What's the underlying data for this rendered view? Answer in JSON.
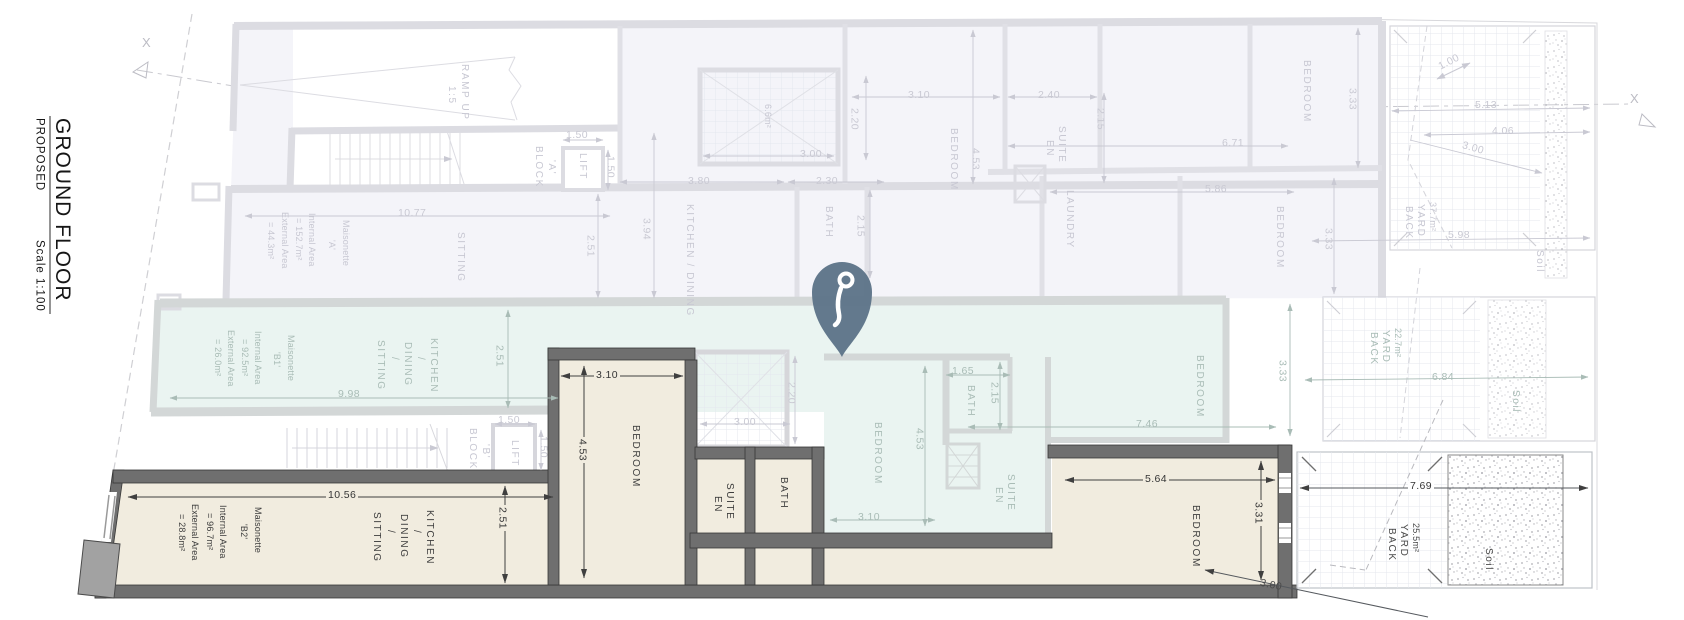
{
  "title_block": {
    "floor": "GROUND FLOOR",
    "status": "PROPOSED",
    "scale": "Scale 1:100"
  },
  "section_markers": {
    "left": "X",
    "right": "X"
  },
  "maisonette_a": {
    "name": "Maisonette",
    "unit_id": "'A'",
    "internal_label": "Internal Area",
    "internal_value": "= 152.7m²",
    "external_label": "External Area",
    "external_value": "= 44.3m²"
  },
  "maisonette_b1": {
    "name": "Maisonette",
    "unit_id": "'B1'",
    "internal_label": "Internal Area",
    "internal_value": "= 92.5m²",
    "external_label": "External Area",
    "external_value": "= 26.0m²"
  },
  "maisonette_b2": {
    "name": "Maisonette",
    "unit_id": "'B2'",
    "internal_label": "Internal Area",
    "internal_value": "= 96.7m²",
    "external_label": "External Area",
    "external_value": "= 28.8m²"
  },
  "labels_a": {
    "ramp_1": "RAMP UP",
    "ramp_2": "1:5",
    "block_1": "BLOCK",
    "block_2": "'A'",
    "lift": "LIFT",
    "sitting": "SITTING",
    "kitchen_dining": "KITCHEN / DINING",
    "bath": "BATH",
    "bedroom_1": "BEDROOM",
    "en_suite_1": "EN",
    "en_suite_2": "SUITE",
    "laundry": "LAUNDRY",
    "bedroom_2": "BEDROOM",
    "bedroom_3": "BEDROOM",
    "shaft_area": "6.6m²",
    "back_1": "BACK",
    "back_2": "YARD",
    "back_area": "37.7m²",
    "soil": "Soil"
  },
  "labels_b1": {
    "kds_1": "SITTING",
    "kds_2": "/",
    "kds_3": "DINING",
    "kds_4": "/",
    "kds_5": "KITCHEN",
    "bedroom_1": "BEDROOM",
    "bath": "BATH",
    "en_suite_1": "EN",
    "en_suite_2": "SUITE",
    "bedroom_2": "BEDROOM",
    "back_1": "BACK",
    "back_2": "YARD",
    "back_area": "22.7m²",
    "soil": "Soil"
  },
  "labels_blockb": {
    "block_1": "BLOCK",
    "block_2": "'B'",
    "lift": "LIFT"
  },
  "labels_b2": {
    "kds_1": "SITTING",
    "kds_2": "/",
    "kds_3": "DINING",
    "kds_4": "/",
    "kds_5": "KITCHEN",
    "bedroom_1": "BEDROOM",
    "en_suite_1": "EN",
    "en_suite_2": "SUITE",
    "bath": "BATH",
    "bedroom_2": "BEDROOM",
    "back_1": "BACK",
    "back_2": "YARD",
    "back_area": "25.5m²",
    "soil": "Soil"
  },
  "dims_a": {
    "lift_w": "1.50",
    "lift_d": "1.50",
    "sitting_w": "10.77",
    "sitting_d": "2.51",
    "kitchen_d": "3.94",
    "kitchen_w": "3.80",
    "bath_w": "2.30",
    "shaft_w": "3.00",
    "shaft_d": "2.20",
    "bath_d": "2.15",
    "bedroom1_w": "3.10",
    "bedroom1_d": "4.53",
    "ensuite_w": "2.40",
    "ensuite_d": "2.15",
    "bedroom2_w": "6.71",
    "bedroom2_d": "3.33",
    "bedroom3_w": "5.86",
    "bedroom3_d": "3.33",
    "yard_step": "1.00",
    "yard_w1": "5.13",
    "yard_w2": "4.06",
    "yard_diag": "3.00",
    "yard_w3": "5.98"
  },
  "dims_b1": {
    "kds_w": "9.98",
    "kds_d": "2.51",
    "shaft_w": "3.00",
    "shaft_d": "2.20",
    "bath_w": "1.65",
    "bath_d": "2.15",
    "bedroom1_d": "4.53",
    "bedroom1_w": "3.10",
    "unit_w": "7.46",
    "yard_d": "3.33",
    "yard_w": "6.84"
  },
  "dims_blockb": {
    "lift_w": "1.50",
    "lift_d": "1.50"
  },
  "dims_b2": {
    "kds_w": "10.56",
    "kds_d": "2.51",
    "bedroom1_w": "3.10",
    "bedroom1_d": "4.53",
    "bedroom2_w": "5.64",
    "bedroom2_d": "3.31",
    "yard_w": "7.69",
    "site_d": "3.00"
  },
  "colors": {
    "highlight_fill": "#f1ecdf",
    "teal_fill": "#eaf4f1",
    "faded_fill": "#f4f4f9",
    "pin": "#5d7488",
    "dark_wall": "#6f6f6f"
  }
}
